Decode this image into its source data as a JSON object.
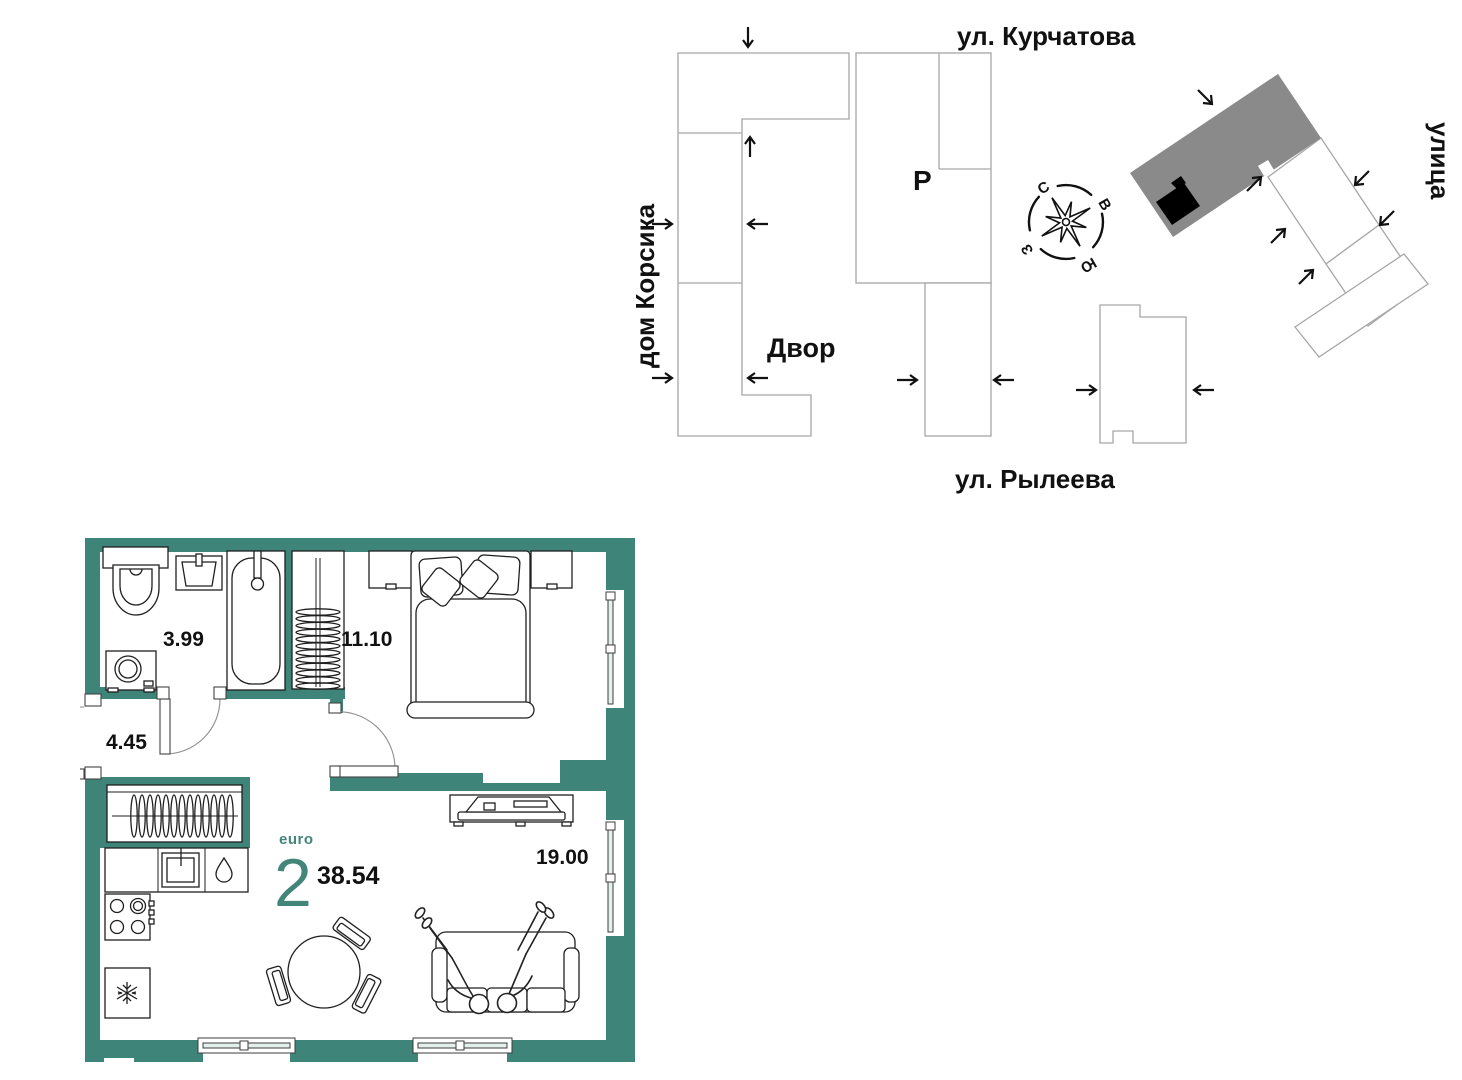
{
  "site_plan": {
    "street_top": "ул. Курчатова",
    "street_bottom": "ул. Рылеева",
    "building_left": "дом Корсика",
    "street_right": "улица",
    "courtyard": "Двор",
    "parking": "Р",
    "compass": {
      "n": "С",
      "e": "В",
      "s": "Ю",
      "w": "З"
    }
  },
  "apartment": {
    "type_label": "euro",
    "rooms_count": "2",
    "total_area": "38.54",
    "areas": {
      "bathroom": "3.99",
      "bedroom": "11.10",
      "hallway": "4.45",
      "kitchen_living": "19.00"
    }
  },
  "colors": {
    "wall": "#3F8478",
    "accent_text": "#438578",
    "highlighted_building": "#8a8a8a",
    "location_marker": "#000000",
    "building_outline": "#a6a6a6"
  }
}
